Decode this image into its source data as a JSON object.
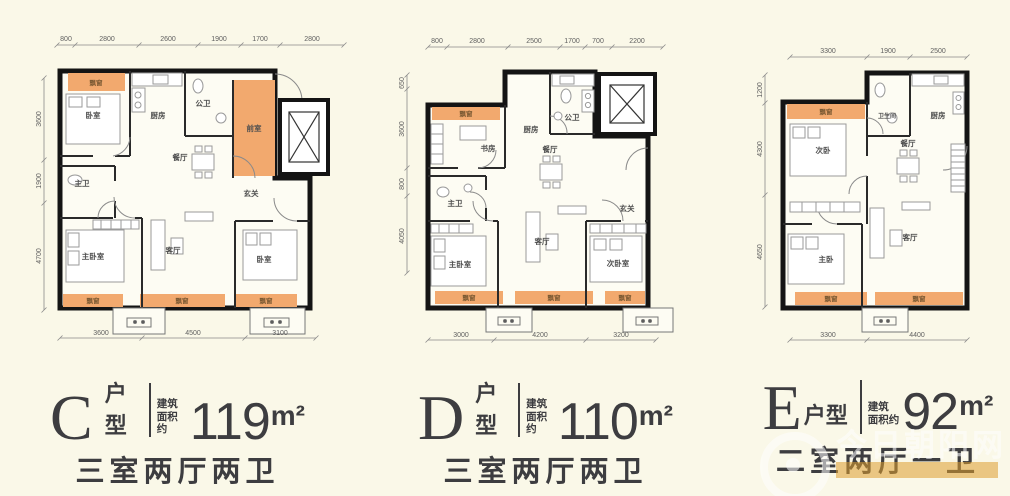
{
  "page": {
    "background": "#FAF8E8"
  },
  "watermark": {
    "site_name": "今日朝阳网"
  },
  "plans": [
    {
      "id": "C",
      "label": {
        "letter": "C",
        "suffix": "户型",
        "note1": "建筑",
        "note2": "面积约",
        "area_value": "119",
        "area_unit": "m²",
        "layout": "三室两厅两卫"
      },
      "dims": {
        "top": [
          "800",
          "2800",
          "2600",
          "1900",
          "1700",
          "2800"
        ],
        "left": [
          "3600",
          "1900",
          "4700"
        ],
        "bottom": [
          "3600",
          "4500",
          "3100"
        ]
      },
      "rooms": {
        "bay_top": "飘窗",
        "bedroom_top": "卧室",
        "kitchen": "厨房",
        "bath_public": "公卫",
        "front_room": "前室",
        "dining": "餐厅",
        "foyer": "玄关",
        "bath_master": "主卫",
        "bedroom_master": "主卧室",
        "living": "客厅",
        "bedroom_right": "卧室",
        "bay_b1": "飘窗",
        "bay_b2": "飘窗",
        "bay_b3": "飘窗"
      }
    },
    {
      "id": "D",
      "label": {
        "letter": "D",
        "suffix": "户型",
        "note1": "建筑",
        "note2": "面积约",
        "area_value": "110",
        "area_unit": "m²",
        "layout": "三室两厅两卫"
      },
      "dims": {
        "top": [
          "800",
          "2800",
          "2500",
          "1700",
          "700",
          "2200"
        ],
        "left": [
          "650",
          "3600",
          "800",
          "4050"
        ],
        "bottom": [
          "3000",
          "4200",
          "3200"
        ]
      },
      "rooms": {
        "bay_top": "飘窗",
        "study": "书房",
        "kitchen": "厨房",
        "bath_public": "公卫",
        "dining": "餐厅",
        "foyer": "玄关",
        "bath_master": "主卫",
        "bedroom_master": "主卧室",
        "living": "客厅",
        "bedroom_second": "次卧室",
        "bay_b1": "飘窗",
        "bay_b2": "飘窗",
        "bay_b3": "飘窗"
      }
    },
    {
      "id": "E",
      "label": {
        "letter": "E",
        "suffix": "户型",
        "note1": "建筑",
        "note2": "面积约",
        "area_value": "92",
        "area_unit": "m²",
        "layout": "二室两厅一卫"
      },
      "dims": {
        "top": [
          "3300",
          "1900",
          "2500"
        ],
        "left": [
          "1200",
          "4300",
          "4650"
        ],
        "bottom": [
          "3300",
          "4400"
        ]
      },
      "rooms": {
        "bay_top": "飘窗",
        "bedroom_second": "次卧",
        "bathroom": "卫生间",
        "kitchen": "厨房",
        "dining": "餐厅",
        "bedroom_master": "主卧",
        "living": "客厅",
        "bay_b1": "飘窗",
        "bay_b2": "飘窗"
      }
    }
  ]
}
